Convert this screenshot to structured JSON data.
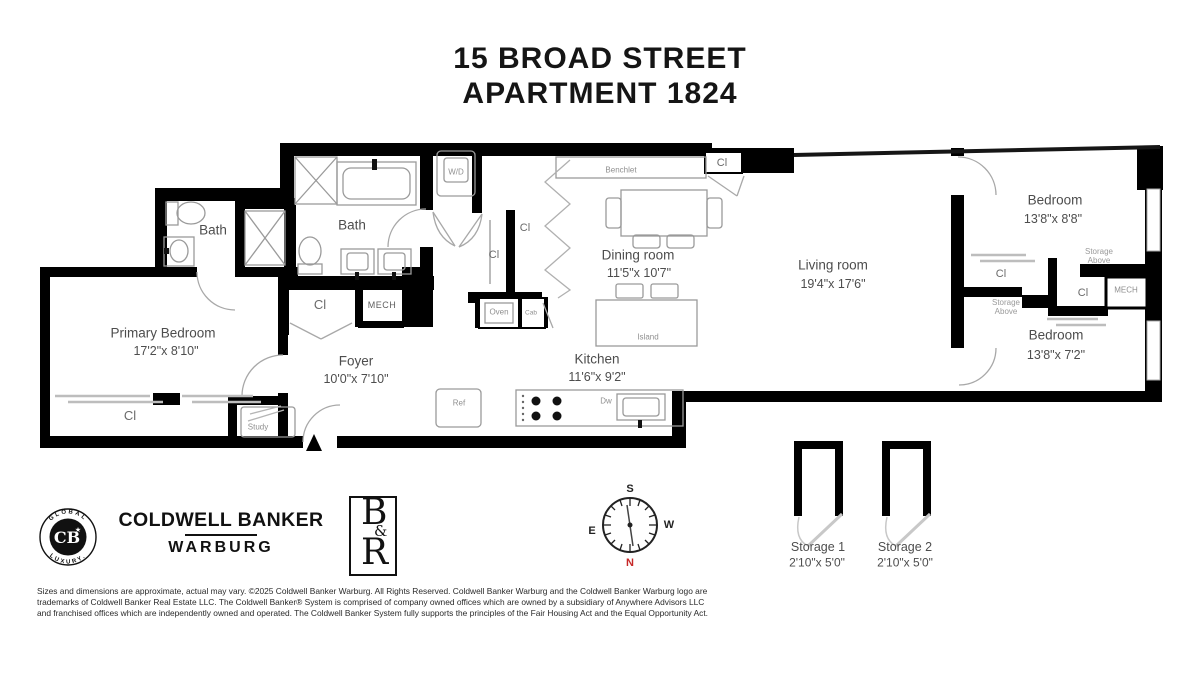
{
  "title": {
    "line1": "15 BROAD STREET",
    "line2": "APARTMENT 1824"
  },
  "rooms": {
    "primary_bedroom": {
      "name": "Primary Bedroom",
      "dims": "17'2\"x 8'10\""
    },
    "bath_primary": {
      "name": "Bath"
    },
    "bath_main": {
      "name": "Bath"
    },
    "foyer": {
      "name": "Foyer",
      "dims": "10'0\"x 7'10\""
    },
    "dining_room": {
      "name": "Dining room",
      "dims": "11'5\"x 10'7\""
    },
    "kitchen": {
      "name": "Kitchen",
      "dims": "11'6\"x 9'2\""
    },
    "living_room": {
      "name": "Living room",
      "dims": "19'4\"x 17'6\""
    },
    "bedroom_north": {
      "name": "Bedroom",
      "dims": "13'8\"x 8'8\""
    },
    "bedroom_south": {
      "name": "Bedroom",
      "dims": "13'8\"x 7'2\""
    }
  },
  "labels": {
    "closet": "Cl",
    "washer_dryer": "W/D",
    "mech": "MECH",
    "oven": "Oven",
    "cab": "Cab",
    "ref": "Ref",
    "dishwasher": "Dw",
    "island": "Island",
    "benchlet": "Benchlet",
    "study": "Study",
    "storage_above": "Storage Above"
  },
  "storage_units": [
    {
      "name": "Storage 1",
      "dims": "2'10\"x 5'0\""
    },
    {
      "name": "Storage 2",
      "dims": "2'10\"x 5'0\""
    }
  ],
  "compass": {
    "north": "N",
    "south": "S",
    "east": "E",
    "west": "W"
  },
  "branding": {
    "seal_top": "GLOBAL",
    "seal_bottom": "LUXURY.",
    "seal_monogram": "CB",
    "seal_star": "★",
    "firm_line1": "COLDWELL BANKER",
    "firm_line2": "WARBURG",
    "monogram_b": "B",
    "monogram_amp": "&",
    "monogram_r": "R"
  },
  "footer": {
    "line1": "Sizes and dimensions are approximate, actual may vary. ©2025 Coldwell Banker Warburg. All Rights Reserved. Coldwell Banker Warburg and the Coldwell Banker Warburg logo are",
    "line2": "trademarks of Coldwell Banker Real Estate LLC. The Coldwell Banker® System is comprised of company owned offices which are owned by a subsidiary of Anywhere Advisors LLC",
    "line3": "and franchised offices which are independently owned and operated. The Coldwell Banker System fully supports the principles of the Fair Housing Act and the Equal Opportunity Act."
  },
  "colors": {
    "wall": "#000000",
    "fixture_gray": "#9a9a9a",
    "room_label": "#4d4d4d",
    "small_label": "#8f8f8f",
    "north_red": "#c62828"
  }
}
